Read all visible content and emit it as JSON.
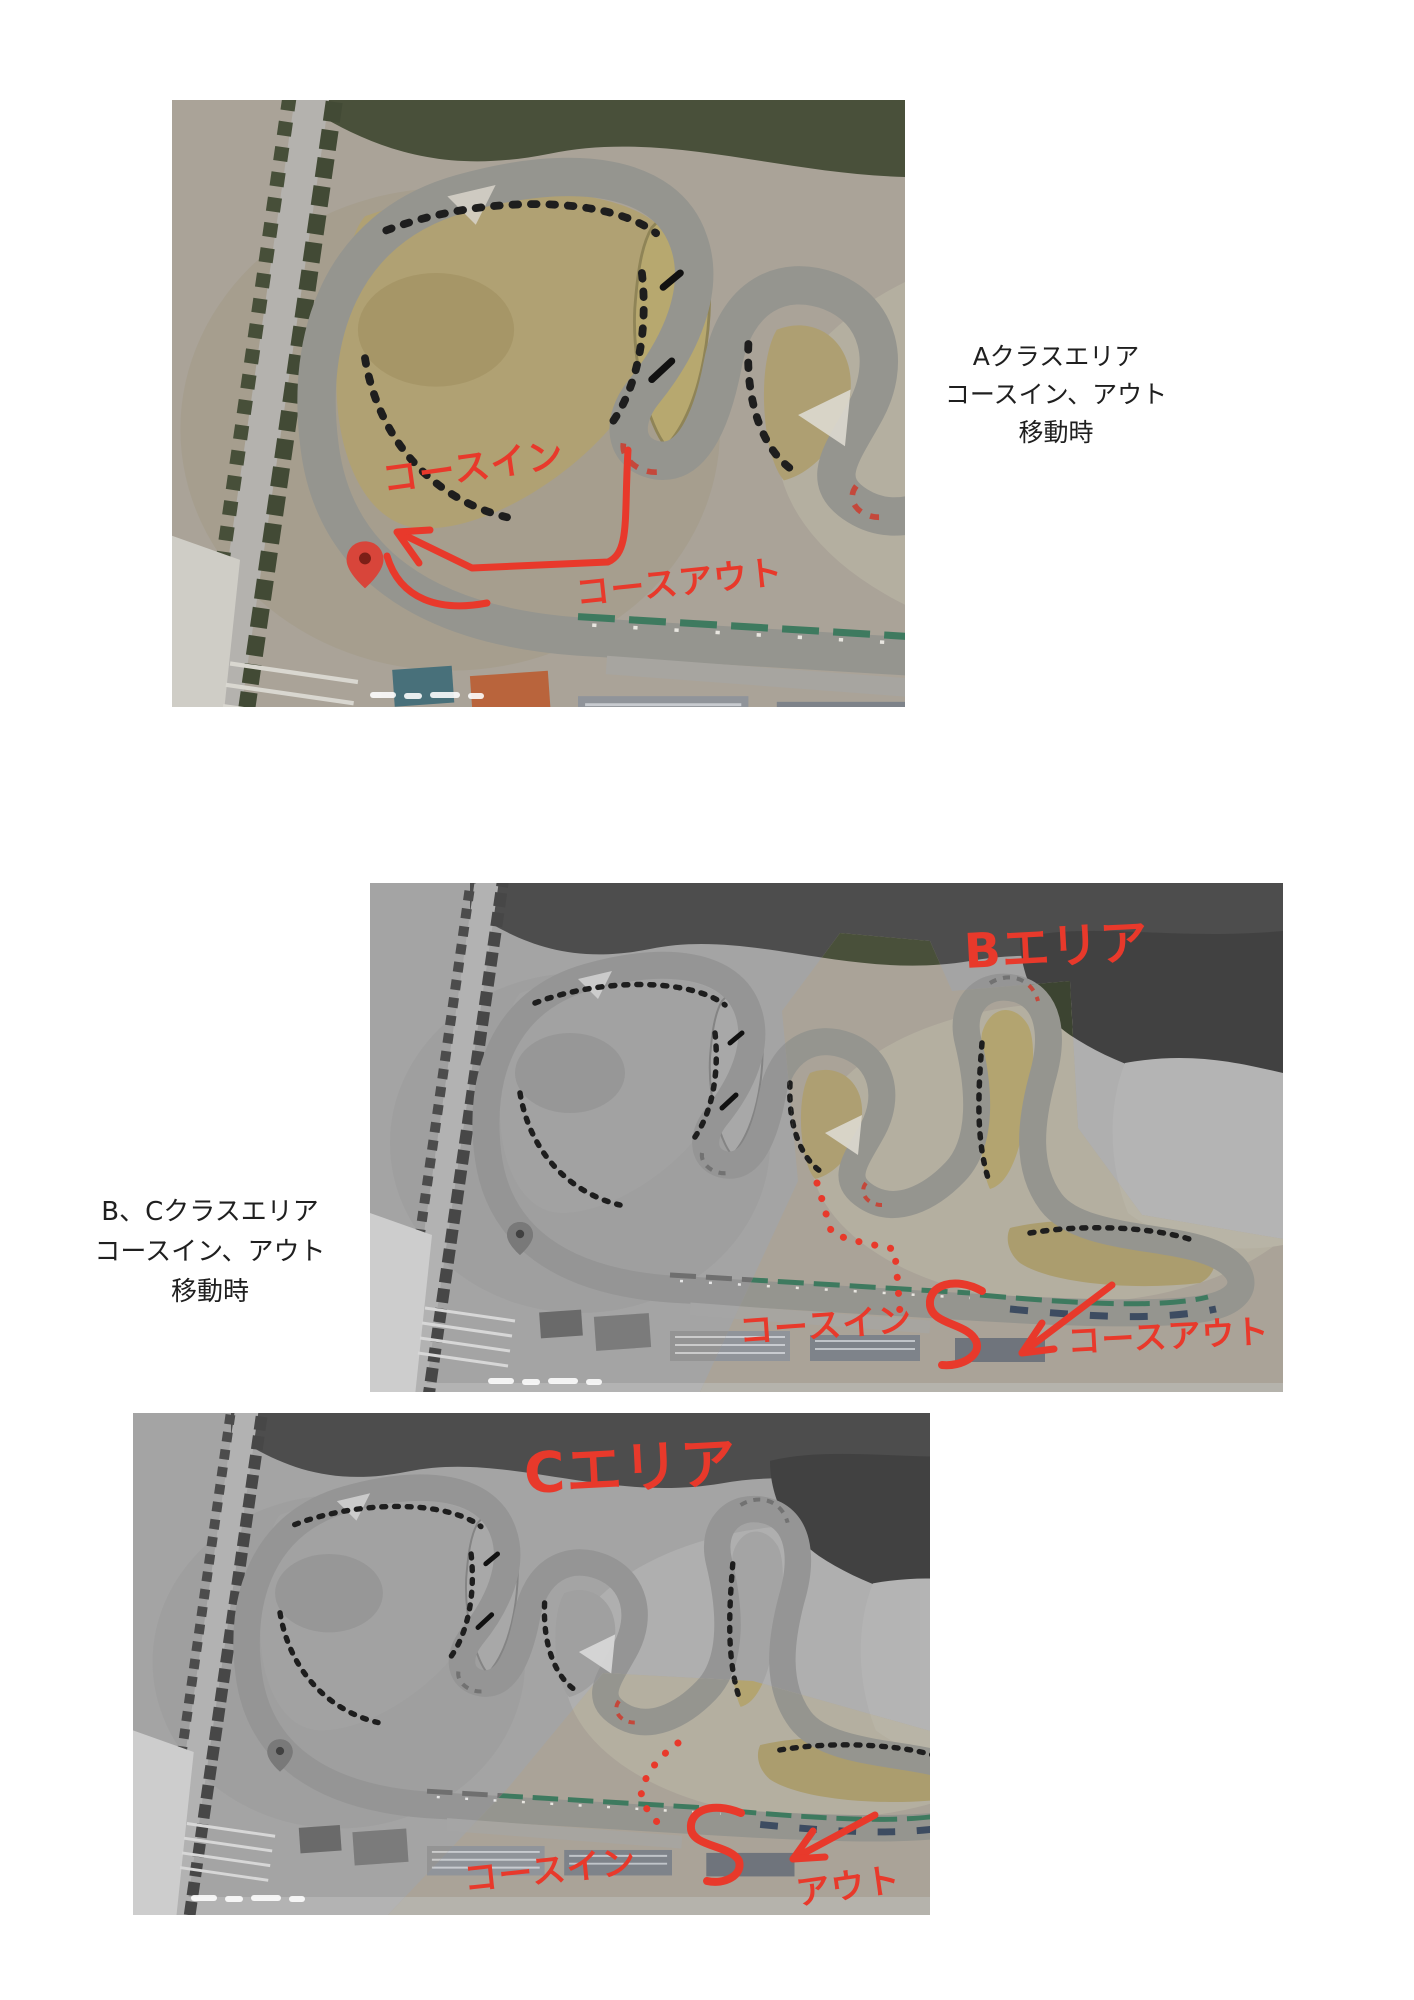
{
  "colors": {
    "red-ink": "#e8392b",
    "caption-ink": "#1f1f1f",
    "page-bg": "#ffffff"
  },
  "captions": {
    "a": {
      "line1": "Aクラスエリア",
      "line2": "コースイン、アウト",
      "line3": "移動時"
    },
    "bc": {
      "line1": "B、Cクラスエリア",
      "line2": "コースイン、アウト",
      "line3": "移動時"
    }
  },
  "photo_a": {
    "course_in": "コースイン",
    "course_out": "コースアウト"
  },
  "photo_b": {
    "area": "Bエリア",
    "course_in": "コースイン",
    "course_out": "コースアウト"
  },
  "photo_c": {
    "area": "Cエリア",
    "course_in": "コースイン",
    "course_out": "アウト"
  }
}
